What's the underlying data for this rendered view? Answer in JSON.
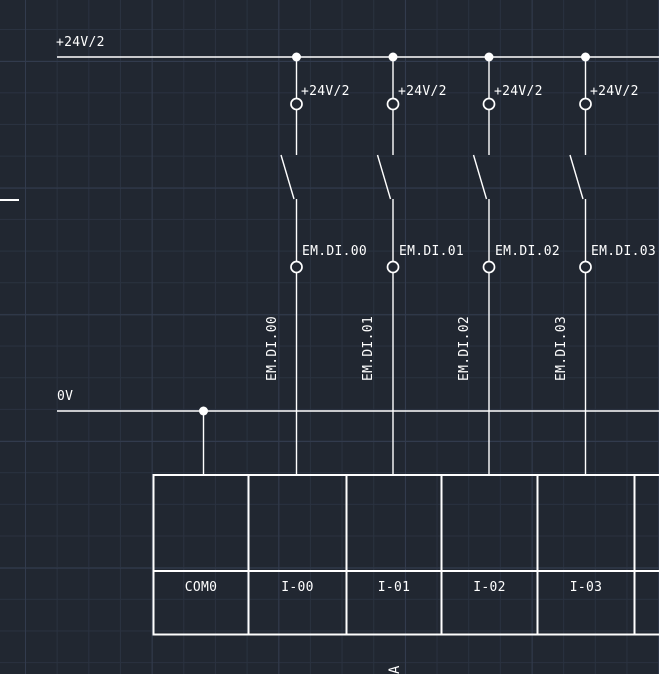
{
  "colors": {
    "background": "#212731",
    "grid_minor": "#2a3240",
    "grid_major": "#323b4d",
    "stroke": "#ffffff"
  },
  "labels": {
    "power_bus": "+24V/2",
    "ground_bus": "0V",
    "footer_marker": "A"
  },
  "branches": [
    {
      "supply_label": "+24V/2",
      "input_label": "EM.DI.00",
      "wire_tag": "EM.DI.00"
    },
    {
      "supply_label": "+24V/2",
      "input_label": "EM.DI.01",
      "wire_tag": "EM.DI.01"
    },
    {
      "supply_label": "+24V/2",
      "input_label": "EM.DI.02",
      "wire_tag": "EM.DI.02"
    },
    {
      "supply_label": "+24V/2",
      "input_label": "EM.DI.03",
      "wire_tag": "EM.DI.03"
    }
  ],
  "terminal_block": {
    "cells": [
      "COM0",
      "I-00",
      "I-01",
      "I-02",
      "I-03"
    ]
  }
}
